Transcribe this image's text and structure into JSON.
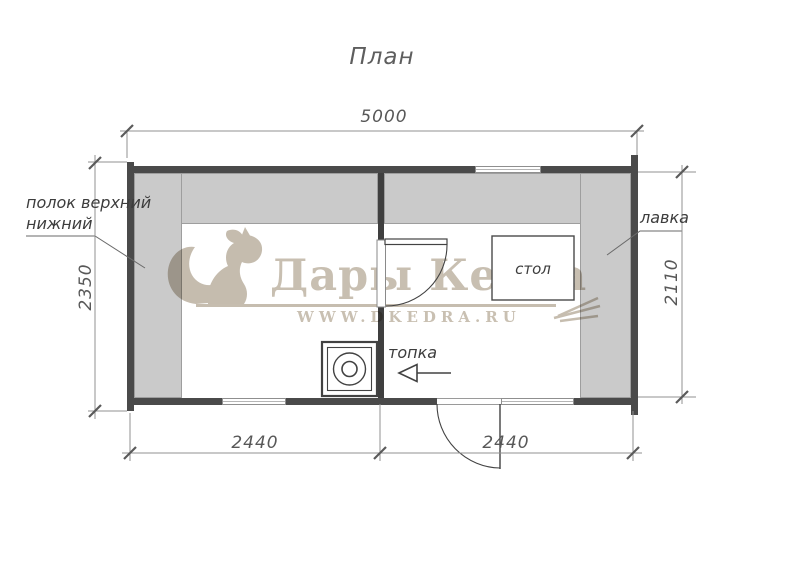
{
  "title": "План",
  "plan": {
    "room_labels": {
      "shelf_upper": "полок верхний",
      "shelf_lower": "нижний",
      "bench": "лавка",
      "table": "стол",
      "furnace": "топка"
    },
    "dimensions": {
      "overall_width": "5000",
      "left_height": "2350",
      "right_height": "2110",
      "left_room_width": "2440",
      "right_room_width": "2440"
    }
  },
  "watermark": {
    "brand": "Дары Кедра",
    "website": "WWW.DKEDRA.RU"
  },
  "colors": {
    "wall": "#4a4a4a",
    "shelf_fill": "#cacaca",
    "line_dark": "#424242",
    "dimension_line": "#8f8f8f",
    "text": "#3d3d3d",
    "watermark_beige": "#c8bfb1"
  }
}
